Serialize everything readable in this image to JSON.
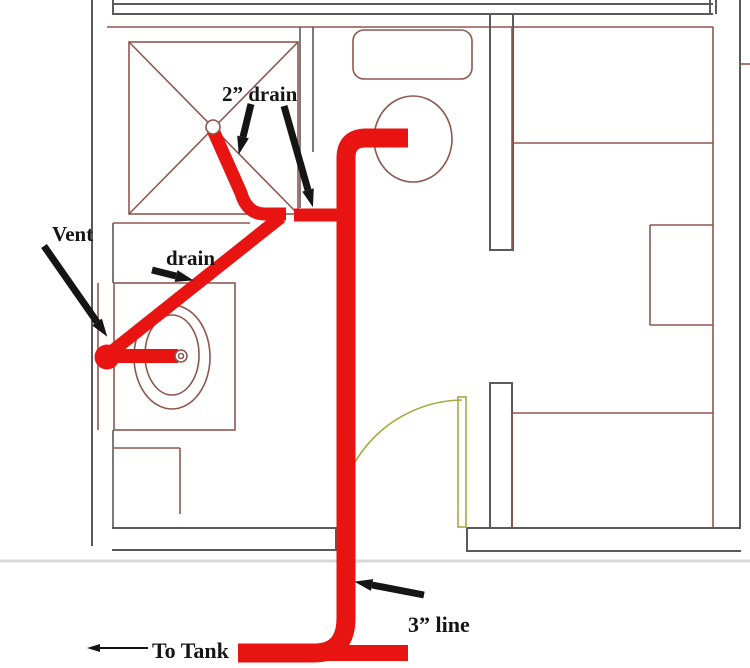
{
  "title": "Bathroom drain and vent plumbing rough-in over floor plan",
  "labels": {
    "vent": "Vent",
    "drain": "drain",
    "drain2": "2” drain",
    "line3": "3” line",
    "to_tank": "To Tank"
  },
  "fixtures": {
    "shower": "shower pan with drain",
    "sink": "lavatory sink with drain",
    "toilet": "toilet with tank",
    "door": "door with swing arc"
  },
  "colors": {
    "pipe_red": "#e81411",
    "plan_maroon": "#8f564e",
    "wall_gray": "#5a5a5a",
    "door_olive": "#a6a93f",
    "ink_black": "#151515",
    "faint_gray": "#d9d9d9"
  }
}
